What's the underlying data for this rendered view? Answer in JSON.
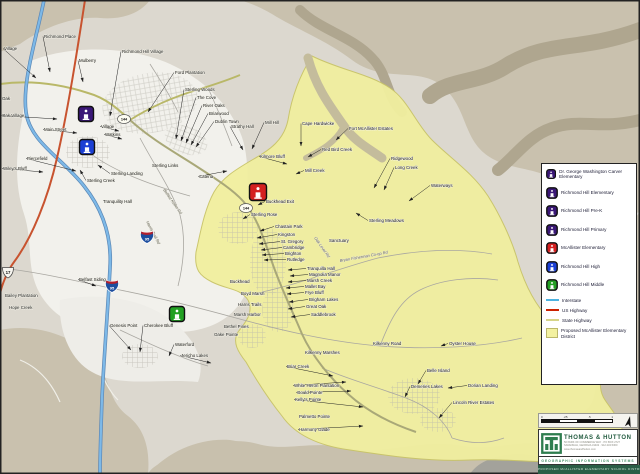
{
  "legend": {
    "schools": [
      {
        "label": "Dr. George Washington Carver Elementary",
        "color": "#3a1777"
      },
      {
        "label": "Richmond Hill Elementary",
        "color": "#3a1777"
      },
      {
        "label": "Richmond Hill Pre-K",
        "color": "#3a1777"
      },
      {
        "label": "Richmond Hill Primary",
        "color": "#3a1777"
      },
      {
        "label": "McAllister Elementary",
        "color": "#d42020"
      },
      {
        "label": "Richmond Hill High",
        "color": "#1b3fd4"
      },
      {
        "label": "Richmond Hill Middle",
        "color": "#22a022"
      }
    ],
    "lines": [
      {
        "label": "Interstate",
        "color": "#4db3e0"
      },
      {
        "label": "US Highway",
        "color": "#cc2200"
      },
      {
        "label": "State Highway",
        "color": "#d6d488"
      }
    ],
    "district": {
      "label": "Proposed McAllister Elementary District",
      "color": "#f3f1a0"
    }
  },
  "colors": {
    "district_fill": "#f1ef9f",
    "interstate": "#7db9e8",
    "us_highway": "#c8532f",
    "state_highway": "#b9b868"
  },
  "map": {
    "schools": [
      {
        "id": "town-elementary-campus",
        "color": "#3a1777",
        "x": 86,
        "y": 114,
        "s": 15
      },
      {
        "id": "richmond-hill-high",
        "color": "#1b3fd4",
        "x": 87,
        "y": 147,
        "s": 15
      },
      {
        "id": "mcallister-elementary",
        "color": "#d42020",
        "x": 258,
        "y": 192,
        "s": 17
      },
      {
        "id": "richmond-hill-middle",
        "color": "#22a022",
        "x": 177,
        "y": 314,
        "s": 15
      }
    ],
    "shields": [
      {
        "k": "us",
        "t": "17",
        "x": 8,
        "y": 272
      },
      {
        "k": "i",
        "t": "95",
        "x": 112,
        "y": 286
      },
      {
        "k": "i",
        "t": "95",
        "x": 147,
        "y": 237
      },
      {
        "k": "s",
        "t": "144",
        "x": 124,
        "y": 119
      },
      {
        "k": "s",
        "t": "144",
        "x": 246,
        "y": 208
      }
    ],
    "labels": [
      {
        "t": "Village",
        "x": 4,
        "y": 50,
        "tx": 36,
        "ty": 78
      },
      {
        "t": "Richmond Place",
        "x": 44,
        "y": 38,
        "tx": 50,
        "ty": 72
      },
      {
        "t": "Mulberry",
        "x": 79,
        "y": 62,
        "tx": 83,
        "ty": 82
      },
      {
        "t": "Richmond Hill Village",
        "x": 122,
        "y": 53,
        "tx": 110,
        "ty": 116
      },
      {
        "t": "Ford Plantation",
        "x": 175,
        "y": 74,
        "tx": 148,
        "ty": 112
      },
      {
        "t": "Sterling Woods",
        "x": 185,
        "y": 91,
        "tx": 176,
        "ty": 139
      },
      {
        "t": "The Cove",
        "x": 197,
        "y": 99,
        "tx": 181,
        "ty": 141
      },
      {
        "t": "River Oaks",
        "x": 203,
        "y": 107,
        "tx": 186,
        "ty": 143
      },
      {
        "t": "Briarwood",
        "x": 209,
        "y": 115,
        "tx": 191,
        "ty": 145
      },
      {
        "t": "Dublin Town",
        "x": 215,
        "y": 123,
        "tx": 196,
        "ty": 147
      },
      {
        "t": "Strathy Hall",
        "x": 231,
        "y": 128,
        "tx": 243,
        "ty": 150
      },
      {
        "t": "Mill Hill",
        "x": 265,
        "y": 124,
        "tx": 252,
        "ty": 149
      },
      {
        "t": "Cape Hardwicke",
        "x": 302,
        "y": 125,
        "tx": 301,
        "ty": 146
      },
      {
        "t": "Fort McAllister Estates",
        "x": 349,
        "y": 130,
        "tx": 336,
        "ty": 140
      },
      {
        "t": "Red Bird Creek",
        "x": 322,
        "y": 151,
        "tx": 308,
        "ty": 157
      },
      {
        "t": "Kilmore Bluff",
        "x": 260,
        "y": 158,
        "tx": 287,
        "ty": 164
      },
      {
        "t": "Mill Creek",
        "x": 305,
        "y": 172,
        "tx": 296,
        "ty": 174
      },
      {
        "t": "Ridgewood",
        "x": 391,
        "y": 160,
        "tx": 374,
        "ty": 188
      },
      {
        "t": "Long Creek",
        "x": 395,
        "y": 169,
        "tx": 384,
        "ty": 190
      },
      {
        "t": "Waterways",
        "x": 431,
        "y": 187,
        "tx": 409,
        "ty": 201
      },
      {
        "t": "Sterling Meadows",
        "x": 369,
        "y": 222,
        "tx": 356,
        "ty": 213
      },
      {
        "t": "Sanctuary",
        "x": 329,
        "y": 242
      },
      {
        "t": "Buckhead Exit",
        "x": 266,
        "y": 203,
        "tx": 258,
        "ty": 205
      },
      {
        "t": "Sterling Rose",
        "x": 251,
        "y": 216,
        "tx": 243,
        "ty": 219
      },
      {
        "t": "Chastain Park",
        "x": 275,
        "y": 228,
        "tx": 260,
        "ty": 231
      },
      {
        "t": "Kingston",
        "x": 278,
        "y": 236,
        "tx": 257,
        "ty": 238
      },
      {
        "t": "St. Gregory",
        "x": 281,
        "y": 243,
        "tx": 259,
        "ty": 244
      },
      {
        "t": "Cambridge",
        "x": 283,
        "y": 249,
        "tx": 261,
        "ty": 250
      },
      {
        "t": "Brighton",
        "x": 285,
        "y": 255,
        "tx": 262,
        "ty": 255
      },
      {
        "t": "Rutledge",
        "x": 287,
        "y": 261,
        "tx": 264,
        "ty": 260
      },
      {
        "t": "Tranquilla Hall",
        "x": 307,
        "y": 270,
        "tx": 288,
        "ty": 270
      },
      {
        "t": "Magnolia Manor",
        "x": 309,
        "y": 276,
        "tx": 290,
        "ty": 276
      },
      {
        "t": "Marsh Creek",
        "x": 307,
        "y": 282,
        "tx": 288,
        "ty": 282
      },
      {
        "t": "Mallet Bay",
        "x": 305,
        "y": 288,
        "tx": 286,
        "ty": 288
      },
      {
        "t": "Frye Bluff",
        "x": 305,
        "y": 294,
        "tx": 287,
        "ty": 294
      },
      {
        "t": "Brigham Lakes",
        "x": 309,
        "y": 301,
        "tx": 289,
        "ty": 302
      },
      {
        "t": "Great Oak",
        "x": 306,
        "y": 308,
        "tx": 288,
        "ty": 309
      },
      {
        "t": "Saddlebrook",
        "x": 311,
        "y": 316,
        "tx": 291,
        "ty": 317
      },
      {
        "t": "Buckhead",
        "x": 230,
        "y": 283
      },
      {
        "t": "Boyd Marsh",
        "x": 241,
        "y": 295
      },
      {
        "t": "Harris Trails",
        "x": 238,
        "y": 306
      },
      {
        "t": "Marsh Harbor",
        "x": 234,
        "y": 316
      },
      {
        "t": "Bethel Pines",
        "x": 224,
        "y": 328
      },
      {
        "t": "Oake Pointe",
        "x": 214,
        "y": 336
      },
      {
        "t": "Main Street",
        "x": 44,
        "y": 131,
        "tx": 77,
        "ty": 133
      },
      {
        "t": "Piercefield",
        "x": 27,
        "y": 160,
        "tx": 76,
        "ty": 171
      },
      {
        "t": "Wiley's Bluff",
        "x": 3,
        "y": 170,
        "tx": 43,
        "ty": 172
      },
      {
        "t": "Sterling Creek",
        "x": 87,
        "y": 182,
        "tx": 80,
        "ty": 170
      },
      {
        "t": "Sterling Landing",
        "x": 111,
        "y": 175,
        "tx": 98,
        "ty": 165
      },
      {
        "t": "Sterling Links",
        "x": 152,
        "y": 167
      },
      {
        "t": "Tranquility Hall",
        "x": 103,
        "y": 203
      },
      {
        "t": "Catena",
        "x": 199,
        "y": 178,
        "tx": 227,
        "ty": 171
      },
      {
        "t": "Oak",
        "x": 2,
        "y": 100
      },
      {
        "t": "Oak Village",
        "x": 2,
        "y": 117,
        "tx": 57,
        "ty": 119
      },
      {
        "t": "Village",
        "x": 101,
        "y": 128,
        "tx": 119,
        "ty": 131
      },
      {
        "t": "Watkins",
        "x": 105,
        "y": 136,
        "tx": 122,
        "ty": 139
      },
      {
        "t": "Belfast Siding",
        "x": 79,
        "y": 281,
        "tx": 96,
        "ty": 286
      },
      {
        "t": "Bailey Plantation",
        "x": 5,
        "y": 297
      },
      {
        "t": "Hope Creek",
        "x": 9,
        "y": 309
      },
      {
        "t": "Genesis Point",
        "x": 110,
        "y": 327,
        "tx": 131,
        "ty": 350
      },
      {
        "t": "Cherokee Bluff",
        "x": 144,
        "y": 327,
        "tx": 140,
        "ty": 352
      },
      {
        "t": "Waterford",
        "x": 175,
        "y": 346,
        "tx": 169,
        "ty": 356
      },
      {
        "t": "Jericho Lakes",
        "x": 181,
        "y": 357,
        "tx": 211,
        "ty": 363
      },
      {
        "t": "Kilkenny Marshes",
        "x": 305,
        "y": 354
      },
      {
        "t": "Kilkenny Road",
        "x": 373,
        "y": 345
      },
      {
        "t": "Briar Creek",
        "x": 287,
        "y": 368,
        "tx": 333,
        "ty": 376
      },
      {
        "t": "White Heron Plantation",
        "x": 294,
        "y": 387,
        "tx": 346,
        "ty": 382
      },
      {
        "t": "Gould Pointe",
        "x": 297,
        "y": 394,
        "tx": 351,
        "ty": 391
      },
      {
        "t": "Kelly's Pointe",
        "x": 295,
        "y": 401,
        "tx": 363,
        "ty": 407
      },
      {
        "t": "Palmetto Pointe",
        "x": 299,
        "y": 418
      },
      {
        "t": "Harmony Glade",
        "x": 299,
        "y": 431,
        "tx": 363,
        "ty": 426
      },
      {
        "t": "Demeries Lakes",
        "x": 411,
        "y": 388,
        "tx": 405,
        "ty": 397
      },
      {
        "t": "Belle Island",
        "x": 427,
        "y": 372,
        "tx": 418,
        "ty": 384
      },
      {
        "t": "Oyster House",
        "x": 449,
        "y": 345,
        "tx": 441,
        "ty": 346
      },
      {
        "t": "Dorian Landing",
        "x": 468,
        "y": 387,
        "tx": 448,
        "ty": 388
      },
      {
        "t": "Lincoln River Estates",
        "x": 453,
        "y": 404,
        "tx": 439,
        "ty": 418
      },
      {
        "t": "Bryan Fisherman Co-op Rd",
        "x": 340,
        "y": 262,
        "r": -10
      },
      {
        "t": "Belfast Keller Rd",
        "x": 163,
        "y": 190,
        "r": 55
      },
      {
        "t": "Harris Trail Rd",
        "x": 146,
        "y": 222,
        "r": 62
      },
      {
        "t": "Oak Level Rd",
        "x": 314,
        "y": 238,
        "r": 55
      }
    ]
  },
  "scalebar": {
    "ticks": [
      "0",
      ".25",
      ".5",
      "1"
    ]
  },
  "footer": {
    "company": "THOMAS & HUTTON",
    "address1": "50 PARK OF COMMERCE WAY · PO BOX 2727",
    "address2": "SAVANNAH, GEORGIA 31402 · 912.234.5300",
    "website": "www.thomasandhutton.com",
    "tagline": "GEOGRAPHIC INFORMATION SYSTEMS",
    "strip_text": "PROPOSED McALLISTER ELEMENTARY SCHOOL DISTRICT"
  }
}
